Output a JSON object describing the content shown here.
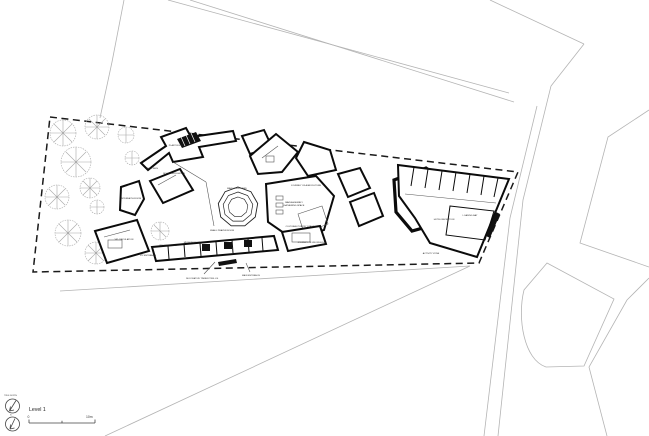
{
  "page": {
    "background": "#ffffff"
  },
  "legend": {
    "level_label": "Level 1",
    "scale_zero": "0",
    "scale_max": "10m",
    "true_north_label": "TRUE NORTH",
    "project_north_label": "N"
  },
  "plan": {
    "colors": {
      "walls": "#0b0b0b",
      "boundary": "#1a1a1a",
      "context_lines": "#b4b4b4",
      "trees": "#a8a8a8"
    },
    "rooms": [
      {
        "name": "PLANT ROOM"
      },
      {
        "name": "NEW LINKS"
      },
      {
        "name": "BOOK CIRCULATION"
      },
      {
        "name": "MAIN COURTYARD"
      },
      {
        "name": "SMALL PRAYER ROOM"
      },
      {
        "name": "MAIN ASSEMBLY"
      },
      {
        "name": "GATHERING SPACE"
      },
      {
        "name": "CULTURAL POETRY STAGE"
      },
      {
        "name": "JOURNEY OF AGRICULTURE"
      },
      {
        "name": "JOURNEY OF KNOWLEDGE"
      },
      {
        "name": "VIP CIRCULATION"
      },
      {
        "name": "VIP ENTRANCE"
      },
      {
        "name": "VIP COURTYARD"
      },
      {
        "name": "MUSEUM SHOP"
      },
      {
        "name": "HOTEL RECEPTION"
      },
      {
        "name": "LOADING BAY"
      },
      {
        "name": "ACTIVITY ZONE"
      },
      {
        "name": "INTERFAITH ROOM"
      }
    ],
    "notes": [
      {
        "text": "DECORATIVE TIMBER TRELLIS"
      },
      {
        "text": "MAIN ENTRANCE"
      }
    ]
  }
}
